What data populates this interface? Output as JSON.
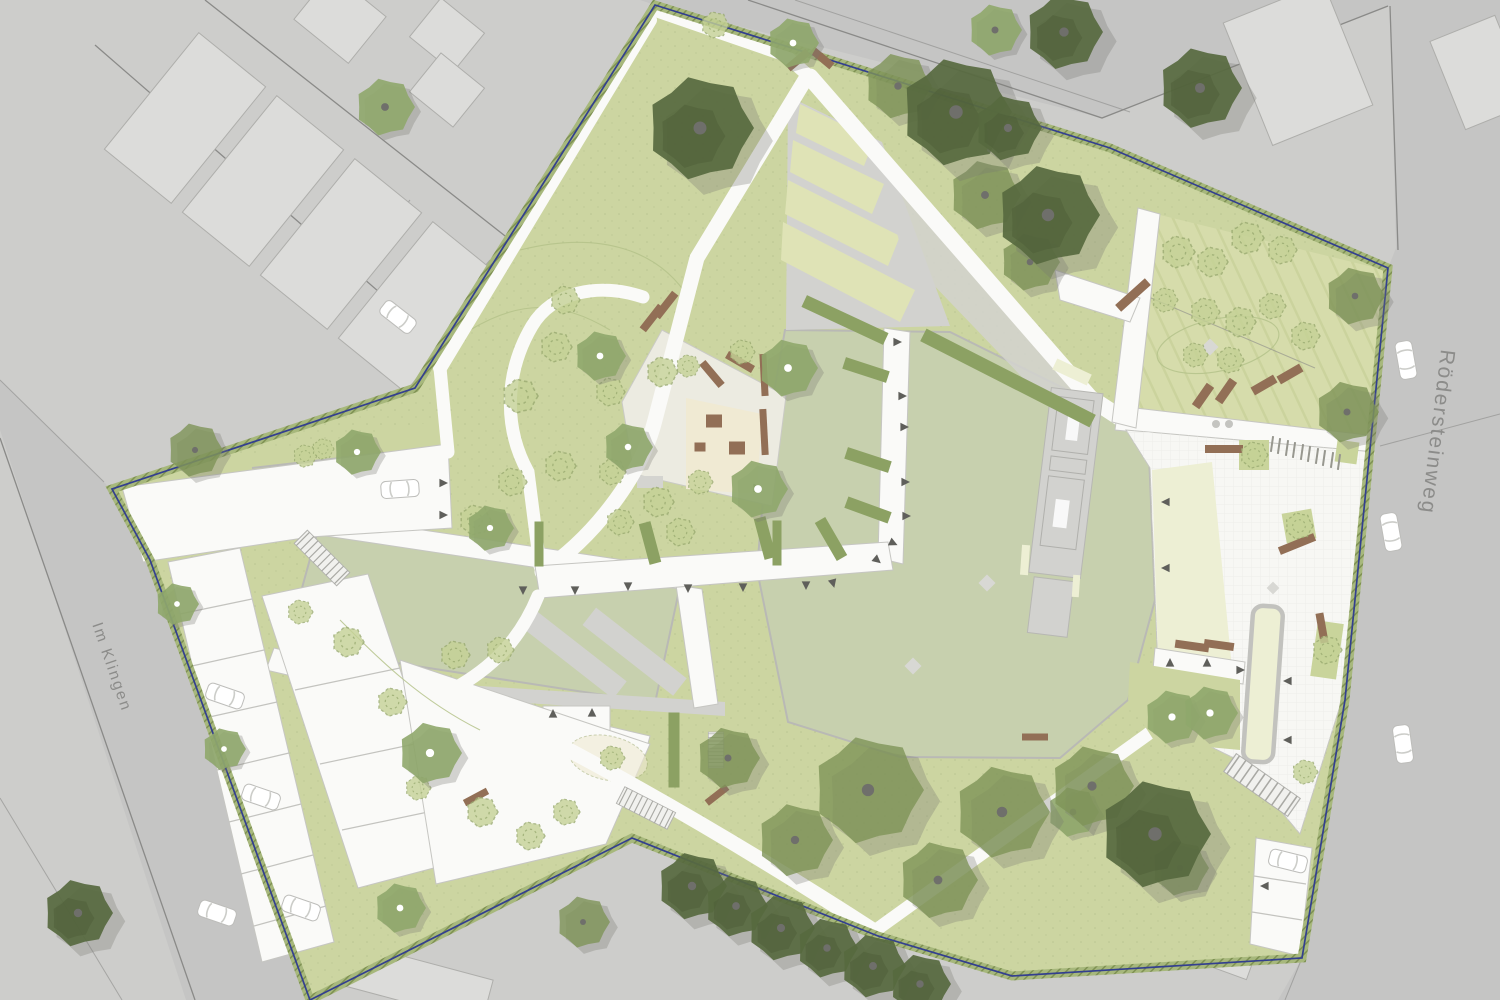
{
  "labels": {
    "street_right": "Rödersteinweg",
    "street_left": "Im Klingen"
  },
  "colors": {
    "bg": "#cdcdcb",
    "road": "#c5c5c4",
    "slab": "#dcdcda",
    "slab_edge": "#aeaeab",
    "line": "#8a8a88",
    "site_green": "#ccd5a1",
    "orchard": "#d6dcab",
    "lawn": "#c7d0ae",
    "terrace": "#dfe3b6",
    "paving": "#fafaf8",
    "plaza": "#f7f7f4",
    "sand": "#f0ead3",
    "cream": "#edefd4",
    "hedge": "#8ca163",
    "planter": "#c9d49b",
    "tree_light": "#c5d296",
    "tree_light_edge": "#99aa70",
    "tree_med": "#8fa76c",
    "tree_canopy": "#7e9458",
    "tree_dark": "#57693f",
    "bench": "#926f56",
    "boundary": "#333f8f",
    "marker": "#5f5f5b",
    "text": "#8c8c8a",
    "path_edge": "#c6c6c2",
    "wall": "#b9b9b5",
    "ramp": "#d2d2cf",
    "bed": "#b4c289"
  },
  "features": {
    "trees_dark": [
      {
        "x": 700,
        "y": 128,
        "s": 5.4
      },
      {
        "x": 956,
        "y": 112,
        "s": 5.6
      },
      {
        "x": 1008,
        "y": 128,
        "s": 3.4
      },
      {
        "x": 1048,
        "y": 215,
        "s": 5.2
      },
      {
        "x": 1064,
        "y": 32,
        "s": 3.9
      },
      {
        "x": 1200,
        "y": 88,
        "s": 4.2
      },
      {
        "x": 1155,
        "y": 834,
        "s": 5.6
      },
      {
        "x": 78,
        "y": 913,
        "s": 3.5
      },
      {
        "x": 692,
        "y": 886,
        "s": 3.5
      },
      {
        "x": 736,
        "y": 906,
        "s": 3.2
      },
      {
        "x": 781,
        "y": 928,
        "s": 3.4
      },
      {
        "x": 827,
        "y": 948,
        "s": 3.1
      },
      {
        "x": 873,
        "y": 966,
        "s": 3.3
      },
      {
        "x": 920,
        "y": 984,
        "s": 3.1
      }
    ],
    "trees_canopy": [
      {
        "x": 868,
        "y": 790,
        "s": 5.6
      },
      {
        "x": 1002,
        "y": 812,
        "s": 4.8
      },
      {
        "x": 1092,
        "y": 786,
        "s": 4.2
      },
      {
        "x": 938,
        "y": 880,
        "s": 4.0
      },
      {
        "x": 795,
        "y": 840,
        "s": 3.8
      },
      {
        "x": 728,
        "y": 758,
        "s": 3.2
      },
      {
        "x": 1180,
        "y": 868,
        "s": 2.9
      },
      {
        "x": 583,
        "y": 922,
        "s": 2.7
      },
      {
        "x": 1355,
        "y": 296,
        "s": 3.0
      },
      {
        "x": 1347,
        "y": 412,
        "s": 3.2
      },
      {
        "x": 898,
        "y": 86,
        "s": 3.4
      },
      {
        "x": 985,
        "y": 195,
        "s": 3.6
      },
      {
        "x": 1030,
        "y": 262,
        "s": 3.0
      },
      {
        "x": 195,
        "y": 450,
        "s": 2.8
      }
    ],
    "trees_medium": [
      {
        "x": 600,
        "y": 356,
        "s": 2.6
      },
      {
        "x": 788,
        "y": 368,
        "s": 3.0
      },
      {
        "x": 758,
        "y": 489,
        "s": 3.0
      },
      {
        "x": 628,
        "y": 447,
        "s": 2.5
      },
      {
        "x": 490,
        "y": 528,
        "s": 2.4
      },
      {
        "x": 357,
        "y": 452,
        "s": 2.4
      },
      {
        "x": 430,
        "y": 753,
        "s": 3.2
      },
      {
        "x": 400,
        "y": 908,
        "s": 2.6
      },
      {
        "x": 224,
        "y": 749,
        "s": 2.2
      },
      {
        "x": 177,
        "y": 604,
        "s": 2.2
      },
      {
        "x": 1172,
        "y": 717,
        "s": 2.8
      },
      {
        "x": 1210,
        "y": 713,
        "s": 2.8
      },
      {
        "x": 793,
        "y": 43,
        "s": 2.6
      }
    ],
    "trees_medium_alt": [
      {
        "x": 385,
        "y": 107,
        "s": 3.0
      },
      {
        "x": 995,
        "y": 30,
        "s": 2.7
      },
      {
        "x": 1073,
        "y": 812,
        "s": 2.6
      }
    ],
    "trees_sketch": [
      {
        "x": 520,
        "y": 396,
        "s": 1.8
      },
      {
        "x": 556,
        "y": 347,
        "s": 1.6
      },
      {
        "x": 610,
        "y": 392,
        "s": 1.5
      },
      {
        "x": 662,
        "y": 372,
        "s": 1.6
      },
      {
        "x": 688,
        "y": 366,
        "s": 1.2
      },
      {
        "x": 742,
        "y": 352,
        "s": 1.3
      },
      {
        "x": 475,
        "y": 520,
        "s": 1.6
      },
      {
        "x": 512,
        "y": 482,
        "s": 1.5
      },
      {
        "x": 560,
        "y": 466,
        "s": 1.6
      },
      {
        "x": 612,
        "y": 472,
        "s": 1.4
      },
      {
        "x": 658,
        "y": 502,
        "s": 1.6
      },
      {
        "x": 700,
        "y": 482,
        "s": 1.3
      },
      {
        "x": 620,
        "y": 522,
        "s": 1.4
      },
      {
        "x": 680,
        "y": 532,
        "s": 1.5
      },
      {
        "x": 305,
        "y": 456,
        "s": 1.2
      },
      {
        "x": 323,
        "y": 449,
        "s": 1.1
      },
      {
        "x": 715,
        "y": 25,
        "s": 1.4
      },
      {
        "x": 565,
        "y": 300,
        "s": 1.5
      },
      {
        "x": 1178,
        "y": 252,
        "s": 1.7
      },
      {
        "x": 1212,
        "y": 262,
        "s": 1.6
      },
      {
        "x": 1247,
        "y": 238,
        "s": 1.7
      },
      {
        "x": 1282,
        "y": 250,
        "s": 1.5
      },
      {
        "x": 1205,
        "y": 312,
        "s": 1.5
      },
      {
        "x": 1240,
        "y": 322,
        "s": 1.6
      },
      {
        "x": 1165,
        "y": 300,
        "s": 1.3
      },
      {
        "x": 1272,
        "y": 306,
        "s": 1.4
      },
      {
        "x": 1305,
        "y": 336,
        "s": 1.5
      },
      {
        "x": 1195,
        "y": 355,
        "s": 1.3
      },
      {
        "x": 1230,
        "y": 360,
        "s": 1.4
      },
      {
        "x": 348,
        "y": 642,
        "s": 1.6
      },
      {
        "x": 392,
        "y": 702,
        "s": 1.5
      },
      {
        "x": 455,
        "y": 655,
        "s": 1.5
      },
      {
        "x": 500,
        "y": 650,
        "s": 1.4
      },
      {
        "x": 482,
        "y": 812,
        "s": 1.6
      },
      {
        "x": 530,
        "y": 836,
        "s": 1.5
      },
      {
        "x": 566,
        "y": 812,
        "s": 1.4
      },
      {
        "x": 300,
        "y": 612,
        "s": 1.3
      },
      {
        "x": 418,
        "y": 788,
        "s": 1.3
      },
      {
        "x": 1254,
        "y": 455,
        "s": 1.4
      },
      {
        "x": 1299,
        "y": 526,
        "s": 1.4
      },
      {
        "x": 1327,
        "y": 650,
        "s": 1.5
      },
      {
        "x": 1305,
        "y": 772,
        "s": 1.3
      },
      {
        "x": 612,
        "y": 758,
        "s": 1.3
      }
    ],
    "benches": [
      {
        "x": 798,
        "y": 60,
        "r": -40,
        "sx": 26,
        "sy": 8
      },
      {
        "x": 822,
        "y": 58,
        "r": 40,
        "sx": 26,
        "sy": 8
      },
      {
        "x": 652,
        "y": 318,
        "r": -52,
        "sx": 30,
        "sy": 8
      },
      {
        "x": 666,
        "y": 305,
        "r": -52,
        "sx": 30,
        "sy": 8
      },
      {
        "x": 712,
        "y": 374,
        "r": 50,
        "sx": 30,
        "sy": 8
      },
      {
        "x": 740,
        "y": 362,
        "r": 30,
        "sx": 30,
        "sy": 8
      },
      {
        "x": 764,
        "y": 375,
        "r": 87,
        "sx": 42,
        "sy": 7
      },
      {
        "x": 764,
        "y": 432,
        "r": 87,
        "sx": 46,
        "sy": 7
      },
      {
        "x": 714,
        "y": 421,
        "r": 0,
        "sx": 16,
        "sy": 13
      },
      {
        "x": 737,
        "y": 448,
        "r": 0,
        "sx": 16,
        "sy": 13
      },
      {
        "x": 700,
        "y": 447,
        "r": 0,
        "sx": 11,
        "sy": 9
      },
      {
        "x": 717,
        "y": 795,
        "r": -38,
        "sx": 26,
        "sy": 7
      },
      {
        "x": 476,
        "y": 797,
        "r": -28,
        "sx": 26,
        "sy": 7
      },
      {
        "x": 1203,
        "y": 396,
        "r": -55,
        "sx": 26,
        "sy": 9
      },
      {
        "x": 1226,
        "y": 391,
        "r": -55,
        "sx": 26,
        "sy": 9
      },
      {
        "x": 1264,
        "y": 385,
        "r": -30,
        "sx": 26,
        "sy": 9
      },
      {
        "x": 1290,
        "y": 374,
        "r": -30,
        "sx": 26,
        "sy": 9
      },
      {
        "x": 1133,
        "y": 295,
        "r": -42,
        "sx": 40,
        "sy": 9
      },
      {
        "x": 1224,
        "y": 449,
        "r": 0,
        "sx": 38,
        "sy": 8
      },
      {
        "x": 1297,
        "y": 544,
        "r": -22,
        "sx": 38,
        "sy": 8
      },
      {
        "x": 1192,
        "y": 646,
        "r": 8,
        "sx": 34,
        "sy": 8
      },
      {
        "x": 1219,
        "y": 645,
        "r": 8,
        "sx": 30,
        "sy": 8
      },
      {
        "x": 1322,
        "y": 628,
        "r": 80,
        "sx": 30,
        "sy": 8
      },
      {
        "x": 1035,
        "y": 737,
        "r": 0,
        "sx": 26,
        "sy": 7
      }
    ],
    "cars": [
      {
        "x": 398,
        "y": 317,
        "r": 38
      },
      {
        "x": 400,
        "y": 489,
        "r": -4
      },
      {
        "x": 225,
        "y": 696,
        "r": 19
      },
      {
        "x": 261,
        "y": 797,
        "r": 19
      },
      {
        "x": 301,
        "y": 908,
        "r": 19
      },
      {
        "x": 217,
        "y": 913,
        "r": 19
      },
      {
        "x": 1406,
        "y": 360,
        "r": 80
      },
      {
        "x": 1391,
        "y": 532,
        "r": 80
      },
      {
        "x": 1403,
        "y": 744,
        "r": 82
      },
      {
        "x": 1288,
        "y": 861,
        "r": 14
      }
    ],
    "markers": [
      {
        "x": 897,
        "y": 342,
        "r": 90
      },
      {
        "x": 902,
        "y": 396,
        "r": 90
      },
      {
        "x": 904,
        "y": 427,
        "r": 90
      },
      {
        "x": 905,
        "y": 482,
        "r": 90
      },
      {
        "x": 906,
        "y": 516,
        "r": 90
      },
      {
        "x": 893,
        "y": 543,
        "r": 115
      },
      {
        "x": 877,
        "y": 560,
        "r": 130
      },
      {
        "x": 628,
        "y": 586,
        "r": 180
      },
      {
        "x": 688,
        "y": 588,
        "r": 180
      },
      {
        "x": 743,
        "y": 587,
        "r": 180
      },
      {
        "x": 806,
        "y": 585,
        "r": 180
      },
      {
        "x": 833,
        "y": 583,
        "r": 165
      },
      {
        "x": 1166,
        "y": 502,
        "r": -90
      },
      {
        "x": 1166,
        "y": 568,
        "r": -90
      },
      {
        "x": 443,
        "y": 483,
        "r": 90
      },
      {
        "x": 443,
        "y": 515,
        "r": 90
      },
      {
        "x": 553,
        "y": 714,
        "r": 0
      },
      {
        "x": 592,
        "y": 713,
        "r": 0
      },
      {
        "x": 523,
        "y": 590,
        "r": 180
      },
      {
        "x": 575,
        "y": 590,
        "r": 180
      },
      {
        "x": 1170,
        "y": 663,
        "r": 0
      },
      {
        "x": 1207,
        "y": 663,
        "r": 0
      },
      {
        "x": 1240,
        "y": 670,
        "r": 90
      },
      {
        "x": 1288,
        "y": 681,
        "r": -90
      },
      {
        "x": 1288,
        "y": 740,
        "r": -90
      },
      {
        "x": 1265,
        "y": 886,
        "r": -90
      },
      {
        "x": 757,
        "y": 488,
        "r": 90
      }
    ],
    "bike_racks": [
      {
        "x": 1272,
        "y": 444,
        "r": 8,
        "sx": 2,
        "sy": 16
      },
      {
        "x": 1279,
        "y": 446,
        "r": 8,
        "sx": 2,
        "sy": 16
      },
      {
        "x": 1287,
        "y": 448,
        "r": 8,
        "sx": 2,
        "sy": 16
      },
      {
        "x": 1294,
        "y": 450,
        "r": 8,
        "sx": 2,
        "sy": 16
      },
      {
        "x": 1302,
        "y": 452,
        "r": 8,
        "sx": 2,
        "sy": 16
      },
      {
        "x": 1309,
        "y": 454,
        "r": 8,
        "sx": 2,
        "sy": 16
      },
      {
        "x": 1317,
        "y": 456,
        "r": 8,
        "sx": 2,
        "sy": 16
      },
      {
        "x": 1324,
        "y": 458,
        "r": 8,
        "sx": 2,
        "sy": 16
      },
      {
        "x": 1332,
        "y": 460,
        "r": 8,
        "sx": 2,
        "sy": 16
      },
      {
        "x": 1339,
        "y": 462,
        "r": 8,
        "sx": 2,
        "sy": 16
      }
    ],
    "diamonds": [
      {
        "x": 987,
        "y": 583,
        "r": 45,
        "sx": 12,
        "sy": 12
      },
      {
        "x": 913,
        "y": 666,
        "r": 45,
        "sx": 12,
        "sy": 12
      },
      {
        "x": 1210,
        "y": 347,
        "r": 45,
        "sx": 12,
        "sy": 12
      },
      {
        "x": 1273,
        "y": 588,
        "r": 45,
        "sx": 9,
        "sy": 9
      }
    ],
    "cream_marks": [
      {
        "x": 1025,
        "y": 560,
        "r": 4,
        "sx": 8,
        "sy": 30
      },
      {
        "x": 1076,
        "y": 586,
        "r": 4,
        "sx": 7,
        "sy": 22
      },
      {
        "x": 1072,
        "y": 372,
        "r": 25,
        "sx": 38,
        "sy": 12
      }
    ],
    "hedges": [
      {
        "x": 845,
        "y": 320,
        "r": 25,
        "sx": 90,
        "sy": 13
      },
      {
        "x": 866,
        "y": 370,
        "r": 18,
        "sx": 46,
        "sy": 12
      },
      {
        "x": 868,
        "y": 460,
        "r": 18,
        "sx": 46,
        "sy": 12
      },
      {
        "x": 868,
        "y": 510,
        "r": 20,
        "sx": 46,
        "sy": 12
      },
      {
        "x": 831,
        "y": 539,
        "r": 60,
        "sx": 44,
        "sy": 12
      },
      {
        "x": 765,
        "y": 538,
        "r": 75,
        "sx": 42,
        "sy": 12
      },
      {
        "x": 650,
        "y": 543,
        "r": 75,
        "sx": 42,
        "sy": 12
      },
      {
        "x": 539,
        "y": 544,
        "r": 90,
        "sx": 45,
        "sy": 9
      },
      {
        "x": 777,
        "y": 543,
        "r": 90,
        "sx": 45,
        "sy": 9
      },
      {
        "x": 1008,
        "y": 378,
        "r": 27,
        "sx": 190,
        "sy": 14
      },
      {
        "x": 674,
        "y": 750,
        "r": 90,
        "sx": 75,
        "sy": 11
      }
    ],
    "stairs": [
      {
        "x": 646,
        "y": 808,
        "r": 27,
        "sx": 0.95,
        "sy": 0.85
      },
      {
        "x": 1262,
        "y": 785,
        "r": 35,
        "sx": 1.3,
        "sy": 1.0
      },
      {
        "x": 322,
        "y": 558,
        "r": 45,
        "sx": 1.0,
        "sy": 0.85
      },
      {
        "x": 716,
        "y": 750,
        "r": 90,
        "sx": 0.6,
        "sy": 0.7
      }
    ],
    "planters": [
      {
        "x": 1254,
        "y": 455,
        "r": 0,
        "sx": 30,
        "sy": 30
      },
      {
        "x": 1299,
        "y": 526,
        "r": -10,
        "sx": 30,
        "sy": 30
      },
      {
        "x": 1327,
        "y": 650,
        "r": 8,
        "sx": 26,
        "sy": 56
      },
      {
        "x": 1347,
        "y": 452,
        "r": 8,
        "sx": 22,
        "sy": 22
      }
    ]
  }
}
